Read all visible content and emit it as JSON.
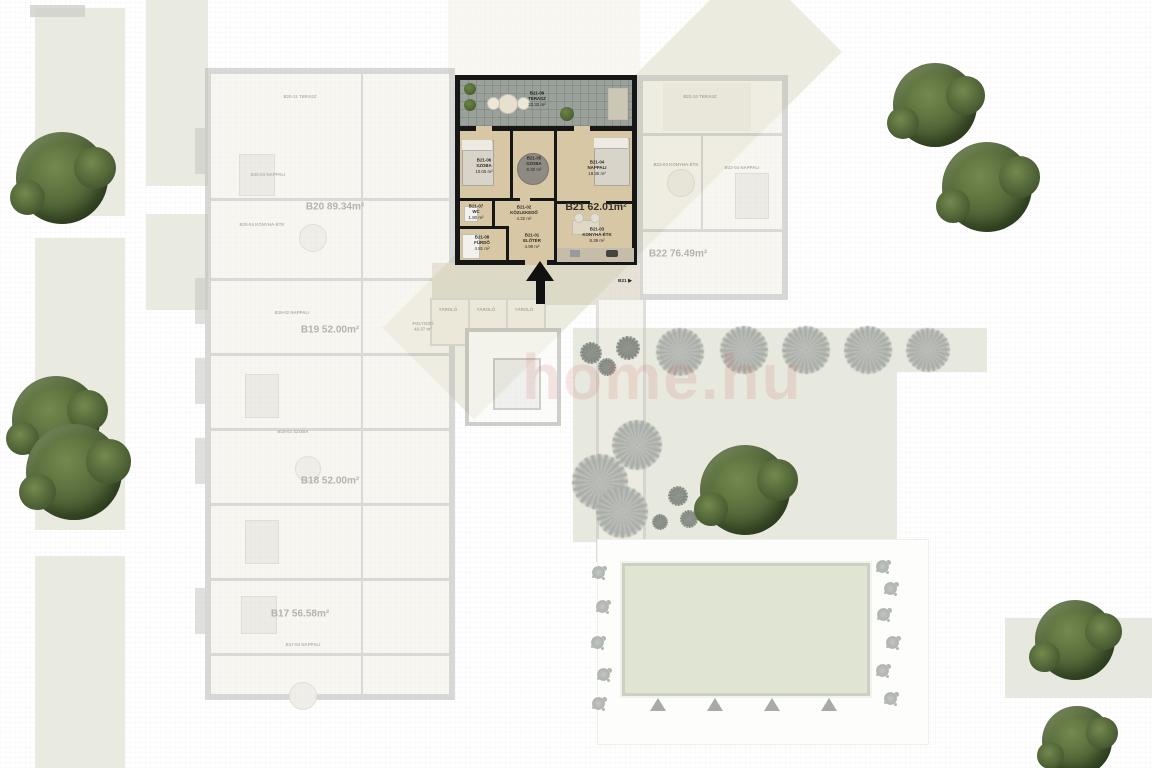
{
  "plan": {
    "watermark": "home.hu",
    "highlighted_unit": {
      "id": "B21",
      "total_label": "B21 62.01m²",
      "entrance_tag": "B21",
      "rooms": [
        {
          "id": "B21-09",
          "name": "TERASZ",
          "area": "22.32 m²"
        },
        {
          "id": "B21-06",
          "name": "SZOBA",
          "area": "10.05 m²"
        },
        {
          "id": "B21-05",
          "name": "SZOBA",
          "area": "9.30 m²"
        },
        {
          "id": "B21-04",
          "name": "NAPPALI",
          "area": "18.35 m²"
        },
        {
          "id": "B21-07",
          "name": "WC",
          "area": "1.80 m²"
        },
        {
          "id": "B21-02",
          "name": "KÖZLEKEDŐ",
          "area": "4.32 m²"
        },
        {
          "id": "B21-08",
          "name": "FÜRDŐ",
          "area": "4.81 m²"
        },
        {
          "id": "B21-01",
          "name": "ELŐTÉR",
          "area": "4.99 m²"
        },
        {
          "id": "B21-03",
          "name": "KONYHA-ÉTK",
          "area": "8.39 m²"
        }
      ]
    },
    "faded_units": [
      {
        "total": "B20 89.34m²"
      },
      {
        "total": "B22 76.49m²"
      },
      {
        "total": "B19 52.00m²"
      },
      {
        "total": "B18 52.00m²"
      },
      {
        "total": "B17 56.58m²"
      }
    ],
    "corridor": {
      "name": "FOLYOSÓ",
      "area": "42.37 m²"
    },
    "storage_label": "TÁROLÓ",
    "faded_room_labels": [
      {
        "text": "B20-11 TERASZ"
      },
      {
        "text": "B20-03 NAPPALI"
      },
      {
        "text": "B20-04 KONYHA-ÉTK"
      },
      {
        "text": "B19-02 NAPPALI"
      },
      {
        "text": "B18-02 SZOBA"
      },
      {
        "text": "B17-04 NAPPALI"
      },
      {
        "text": "B22-10 TERASZ"
      },
      {
        "text": "B22-03 KONYHA-ÉTK"
      },
      {
        "text": "B22-04 NAPPALI"
      }
    ],
    "icons": {
      "entrance_arrow": "▶"
    },
    "colors": {
      "highlight_floor": "#d8c7a4",
      "wall": "#161616",
      "terrace": "#9aa19b",
      "faded_wall": "#b3b3ae",
      "lawn": "#e9ebe1",
      "courtyard": "#e8e9de",
      "pool": "#e0e5d3",
      "tree_green": "#576b3b",
      "tree_gray": "#b6b9b3",
      "watermark_pink": "#c66c62"
    }
  }
}
